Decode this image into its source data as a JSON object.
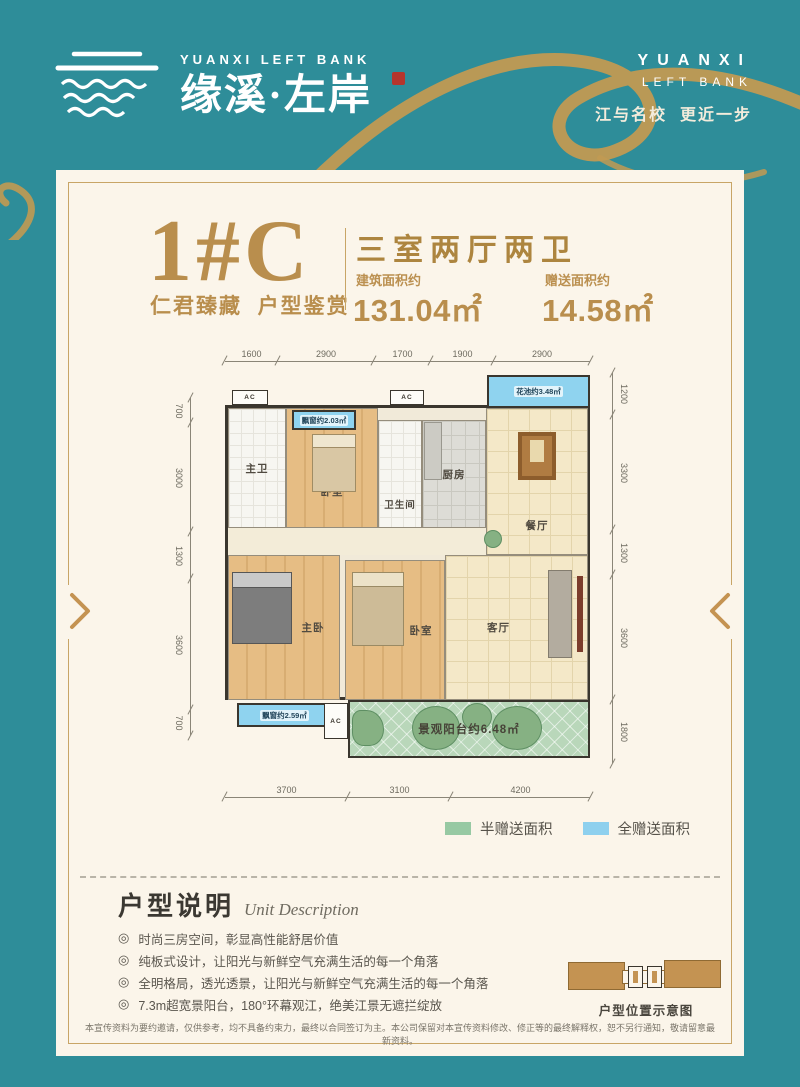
{
  "theme": {
    "teal": "#2e8d99",
    "gold": "#b98e4d",
    "cream": "#fbf5ea",
    "wall": "#3a362e"
  },
  "brand": {
    "logo_en": "YUANXI LEFT BANK",
    "logo_cn": "缘溪·左岸",
    "right_line1": "YUANXI",
    "right_line2": "LEFT BANK",
    "slogan": "江与名校  更近一步"
  },
  "header": {
    "unit_code": "1#C",
    "unit_tagline": "仁君臻藏  户型鉴赏",
    "layout_title": "三室两厅两卫",
    "build_area_label": "建筑面积约",
    "build_area_value": "131.04㎡",
    "gift_area_label": "赠送面积约",
    "gift_area_value": "14.58㎡"
  },
  "floorplan": {
    "dims_top": [
      "1600",
      "2900",
      "1700",
      "1900",
      "2900"
    ],
    "dims_bottom": [
      "3700",
      "3100",
      "4200"
    ],
    "dims_left": [
      "700",
      "3000",
      "1300",
      "3600",
      "700"
    ],
    "dims_right": [
      "1200",
      "3300",
      "1300",
      "3600",
      "1800"
    ],
    "ac_label": "AC",
    "rooms": {
      "master_bath": "主卫",
      "bedroom_top": "卧室",
      "bathroom": "卫生间",
      "kitchen": "厨房",
      "dining": "餐厅",
      "master_bedroom": "主卧",
      "bedroom_mid": "卧室",
      "living": "客厅",
      "balcony": "景观阳台约6.48㎡",
      "flower_pool": "花池约3.48㎡",
      "bay_window_top": "飘窗约2.03㎡",
      "bay_window_bottom": "飘窗约2.59㎡"
    }
  },
  "legend": {
    "half": {
      "label": "半赠送面积",
      "color": "#97c9a3"
    },
    "full": {
      "label": "全赠送面积",
      "color": "#8ed0ee"
    }
  },
  "description": {
    "title_cn": "户型说明",
    "title_en": "Unit Description",
    "bullet_icon": "◎",
    "bullets": [
      "时尚三房空间，彰显高性能舒居价值",
      "纯板式设计，让阳光与新鲜空气充满生活的每一个角落",
      "全明格局，透光透景，让阳光与新鲜空气充满生活的每一个角落",
      "7.3m超宽景阳台，180°环幕观江，绝美江景无遮拦绽放"
    ],
    "location_caption": "户型位置示意图"
  },
  "footer": {
    "disclaimer": "本宣传资料为要约邀请，仅供参考，均不具备约束力，最终以合同签订为主。本公司保留对本宣传资料修改、修正等的最终解释权，恕不另行通知，敬请留意最新资料。"
  }
}
